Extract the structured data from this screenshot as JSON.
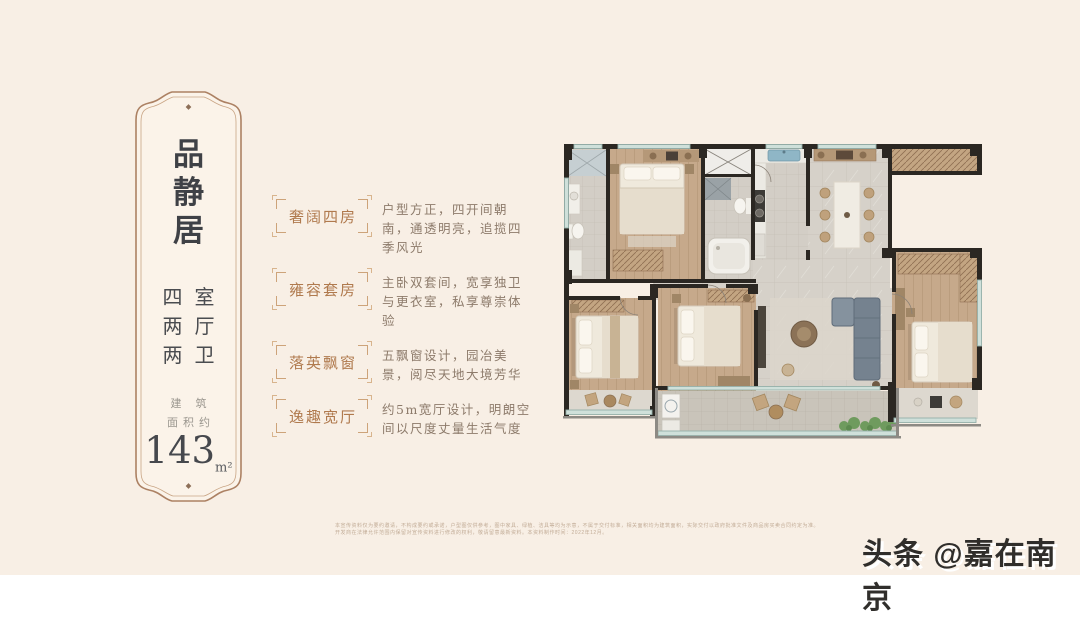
{
  "page": {
    "background": "#f8efe5",
    "accent_brown": "#b08a6a",
    "tag_color": "#b07a4e",
    "text_dark": "#3f4146"
  },
  "plaque": {
    "title": [
      "品",
      "静",
      "居"
    ],
    "specs": [
      "四室",
      "两厅",
      "两卫"
    ],
    "area_label_line1": "建筑",
    "area_label_line2": "面积约",
    "area_value": "143",
    "area_unit": "m²"
  },
  "features": [
    {
      "tag": "奢阔四房",
      "desc": "户型方正，四开间朝南，通透明亮，追揽四季风光"
    },
    {
      "tag": "雍容套房",
      "desc": "主卧双套间，宽享独卫与更衣室，私享尊崇体验"
    },
    {
      "tag": "落英飘窗",
      "desc": "五飘窗设计，园冶美景，阅尽天地大境芳华"
    },
    {
      "tag": "逸趣宽厅",
      "desc": "约5m宽厅设计，明朗空间以尺度丈量生活气度"
    }
  ],
  "disclaimer": {
    "line1": "本宣传资料仅为要约邀请，不构成要约或承诺，户型图仅供参考，图中家具、绿植、洁具等均为示意，不属于交付标准，相关面积均为建筑面积，实际交付以政府批准文件及商品房买卖合同约定为准。",
    "line2": "开发商在法律允许范围内保留对宣传资料进行修改的权利，敬请留意最新资料。本资料制作时间：2022年12月。"
  },
  "watermark": {
    "text": "头条 @嘉在南京"
  }
}
